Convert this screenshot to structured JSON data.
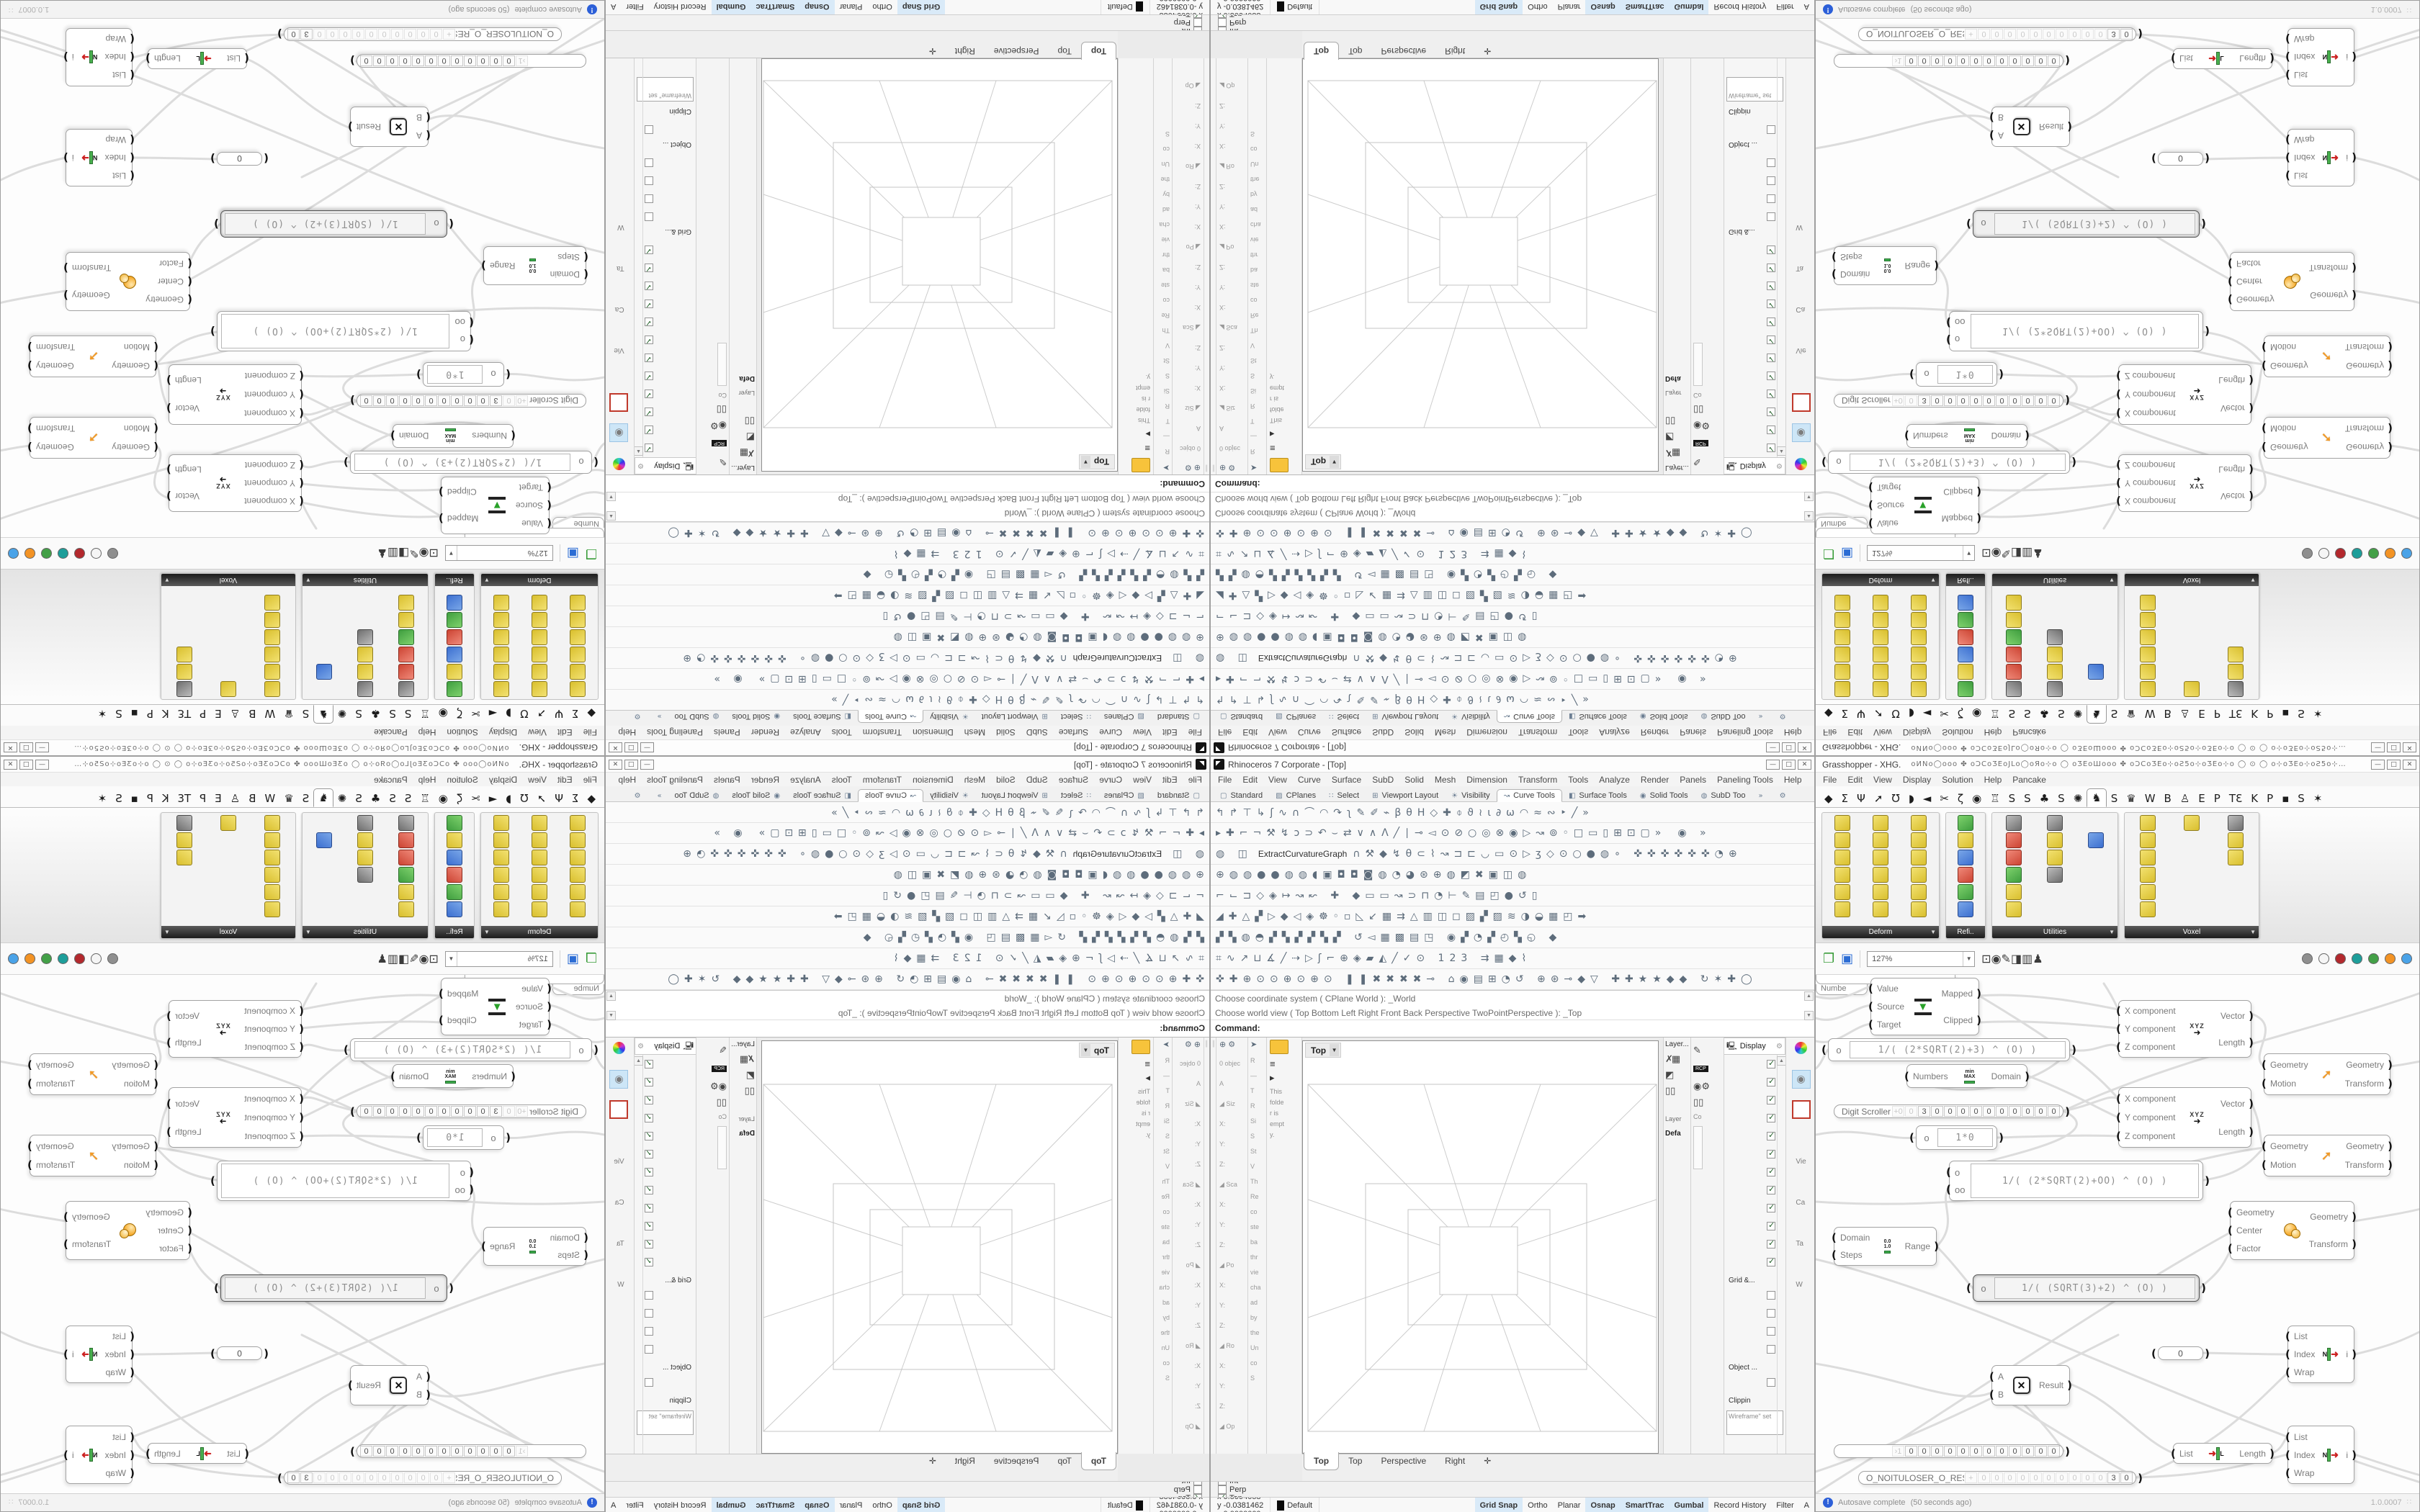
{
  "rhino": {
    "title": "Rhinoceros 7 Corporate - [Top]",
    "window_buttons": [
      "—",
      "□",
      "✕"
    ],
    "menu": [
      "File",
      "Edit",
      "View",
      "Curve",
      "Surface",
      "SubD",
      "Solid",
      "Mesh",
      "Dimension",
      "Transform",
      "Tools",
      "Analyze",
      "Render",
      "Panels",
      "Paneling Tools",
      "Help"
    ],
    "toolbar_tabs": [
      {
        "icon": "▢",
        "label": "Standard"
      },
      {
        "icon": "▨",
        "label": "CPlanes"
      },
      {
        "icon": "∷",
        "label": "Select"
      },
      {
        "icon": "⊞",
        "label": "Viewport Layout"
      },
      {
        "icon": "☀",
        "label": "Visibility"
      },
      {
        "icon": "↝",
        "label": "Curve Tools",
        "active": true
      },
      {
        "icon": "◧",
        "label": "Surface Tools"
      },
      {
        "icon": "◉",
        "label": "Solid Tools"
      },
      {
        "icon": "◍",
        "label": "SubD Too"
      },
      {
        "icon": "»",
        "label": ""
      },
      {
        "icon": "⚙",
        "label": ""
      }
    ],
    "toolbar_rows": [
      {
        "a": "↰↱⊤↳ʃ∿∩⌒◠↷ʅ✎✐⌁βθΗ◇✚⌽ϑ≀ι∂ω◠≈∾‣╱»",
        "label": "",
        "b": ""
      },
      {
        "a": "▸✚⌐¬⚒↯ɔ⊃↶⌣⇄∨∧Λ╱∣⊸◅⊙⊘○◎⊗◉▷↝⊚◦□▭▯⊞⊡▢»",
        "label": "",
        "b": "◉ »"
      },
      {
        "a": "◍ ◫",
        "label": "ExtractCurvatureGraph",
        "b": "∩⚒◆↯θ⊂⌇↝⊐⊏◡▭⊙▷ʒ◇⊙○●◍∘ ✜✜✜✜✜✜◔⊕"
      },
      {
        "a": "⊕◍◍●●◍◍◖▣◘◘◙◍◔◕⊛⊕◍◩✖▣◫◍",
        "label": "",
        "b": ""
      },
      {
        "a": "⌐⌙⊐◇◈↦↝↜ ✚ ◆▭▭↝⊃⊓◔⊢✎▤◰●↺▯",
        "label": "",
        "b": ""
      },
      {
        "a": "◢✚△▞▷◆◁◈☸◦▫◺↙▦⇉△▥◫◻▨▞▨≋◑◒▦◰➡",
        "label": "",
        "b": ""
      },
      {
        "a": "▞▚◍◓▞▚▞▞▚▞ ↺◅▦▩▤◳ ◉▞◔▞◴▚◵ ◆",
        "label": "",
        "b": ""
      },
      {
        "a": "⌗∿↗⊔∡╱⇢▷ʃ⌐⊕◈▰◭╱✓⊙ 123 ⇉▦◆⌇",
        "label": "",
        "b": ""
      },
      {
        "a": "✜✚⊕⊙⊙⊕⊙⊕⊙ ❚❚✖✖✖✖⊸ ⌂◉▤⊞◔↺ ⊕⊛⊸◆▽ ✚✚★★◆◆ ↻✶✚◯",
        "label": "",
        "b": ""
      }
    ],
    "command": {
      "history": [
        "Choose coordinate system ( CPlane  World ): _World",
        "Choose world view ( Top  Bottom  Left  Right  Front  Back  Perspective  TwoPointPerspective ): _Top"
      ],
      "prompt": "Command:"
    },
    "left_panel_a": [
      "0 objec",
      "A",
      "◢ Siz",
      "X:",
      "Y:",
      "Z:",
      "◢ Sca",
      "X:",
      "Y:",
      "Z:",
      "◢ Po",
      "X:",
      "Y:",
      "Z:",
      "◢ Ro",
      "X:",
      "Y:",
      "Z:",
      "◢ Op"
    ],
    "left_panel_b": [
      "R",
      "—",
      "T",
      "R",
      "Si",
      "S",
      "St",
      "V",
      "Th",
      "Re",
      "co",
      "ste",
      "ba",
      "thr",
      "vie",
      "cha",
      "ad",
      "by",
      "the",
      "Un",
      "co",
      "S"
    ],
    "left_panel_c": [
      "This",
      "folde",
      "r is",
      "empt",
      "y."
    ],
    "viewport": {
      "label": "Top",
      "tabs": [
        {
          "label": "Top",
          "active": true
        },
        {
          "label": "Top"
        },
        {
          "label": "Perspective"
        },
        {
          "label": "Right"
        },
        {
          "label": "✛"
        }
      ]
    },
    "layer_panel": {
      "header": "Layer...",
      "list_label": "Layer",
      "item": "Defa"
    },
    "mid_strip": {
      "badge": "RCP",
      "label": "Co"
    },
    "display_panel": {
      "title": "Display",
      "checks": [
        {
          "on": true
        },
        {
          "on": true
        },
        {
          "on": true
        },
        {
          "on": true
        },
        {
          "on": true
        },
        {
          "on": true
        },
        {
          "on": true
        },
        {
          "on": true
        },
        {
          "on": true
        },
        {
          "on": true
        },
        {
          "on": true
        },
        {
          "on": true
        }
      ],
      "grid_label": "Grid &...",
      "grid_checks": [
        {
          "on": false
        },
        {
          "on": false
        },
        {
          "on": false
        },
        {
          "on": false
        }
      ],
      "object_label": "Object ...",
      "object_checks": [
        {
          "on": false
        }
      ],
      "clip_label": "Clippin",
      "setting": "Wireframe\" set"
    },
    "right_strip": [
      "Vie",
      "Ca",
      "Ta",
      "W"
    ],
    "osnap": [
      {
        "label": "End",
        "on": true
      },
      {
        "label": "Near",
        "on": true
      },
      {
        "label": "Point",
        "on": true
      },
      {
        "label": "Mid",
        "on": true
      },
      {
        "label": "Cen",
        "on": true
      },
      {
        "label": "Int",
        "on": true
      },
      {
        "label": "Perp",
        "on": false
      },
      {
        "label": "Tan",
        "on": true
      },
      {
        "label": "Quad",
        "on": true
      },
      {
        "label": "Knot",
        "on": true
      },
      {
        "label": "Vertex",
        "on": true
      },
      {
        "label": "Project",
        "on": false
      },
      {
        "label": "Disable",
        "on": false
      }
    ],
    "status": {
      "segments": [
        "CPlane",
        "x 0.5094058",
        "y -0.0381462",
        "z 0.0000000",
        "Millimeters"
      ],
      "default_label": "Default",
      "toggles": [
        {
          "label": "Grid Snap",
          "on": true
        },
        {
          "label": "Ortho"
        },
        {
          "label": "Planar"
        },
        {
          "label": "Osnap",
          "on": true
        },
        {
          "label": "SmartTrac",
          "on": true
        },
        {
          "label": "Gumbal",
          "on": true
        },
        {
          "label": "Record History"
        },
        {
          "label": "Filter"
        },
        {
          "label": "A"
        }
      ]
    }
  },
  "gh": {
    "title": "Grasshopper - XHG.",
    "title_glyphs": "oИNo◯ooo ✤ oƆCoƷEoJLo◯oЯo⊹o  ◯  oƷEoШooo ✤ oƆCoƷEo⊹oƧ5o⊹oƷEo⊹o  ◯ ⊙ ◯  o⊹oƷEo⊹oƧ5o⊹…",
    "window_buttons": [
      "—",
      "□",
      "✕"
    ],
    "menu": [
      "File",
      "Edit",
      "View",
      "Display",
      "Solution",
      "Help",
      "Pancake"
    ],
    "tabs": [
      {
        "g": "◆"
      },
      {
        "g": "Σ"
      },
      {
        "g": "Ψ"
      },
      {
        "g": "➚"
      },
      {
        "g": "Ʊ"
      },
      {
        "g": "◗"
      },
      {
        "g": "◄"
      },
      {
        "g": "✂"
      },
      {
        "g": "ζ"
      },
      {
        "g": "◉"
      },
      {
        "g": "♖"
      },
      {
        "g": "S"
      },
      {
        "g": "S"
      },
      {
        "g": "♣"
      },
      {
        "g": "S"
      },
      {
        "g": "✺"
      },
      {
        "g": "♞",
        "active": true
      },
      {
        "g": "S"
      },
      {
        "g": "♛"
      },
      {
        "g": "W"
      },
      {
        "g": "B"
      },
      {
        "g": "♙"
      },
      {
        "g": "E"
      },
      {
        "g": "P"
      },
      {
        "g": "TƐ"
      },
      {
        "g": "K"
      },
      {
        "g": "P"
      },
      {
        "g": "▪"
      },
      {
        "g": "S"
      },
      {
        "g": "✶"
      }
    ],
    "palettes": [
      {
        "label": "Deform",
        "cells": [
          "y",
          "y",
          "y",
          "y",
          "y",
          "y",
          "y",
          "y",
          "y",
          "y",
          "y",
          "y",
          "y",
          "y",
          "y",
          "y",
          "y",
          "y"
        ]
      },
      {
        "label": "Refi..",
        "cells": [
          "g",
          "y",
          "b",
          "r",
          "g",
          "b"
        ]
      },
      {
        "label": "Utilities",
        "cells": [
          "k",
          "k",
          "w",
          "r",
          "y",
          "b",
          "r",
          "y",
          "w",
          "g",
          "k",
          "w",
          "y",
          "w",
          "w",
          "y",
          "w",
          "w"
        ]
      },
      {
        "label": "Voxel",
        "cells": [
          "y",
          "y",
          "k",
          "y",
          "w",
          "y",
          "y",
          "w",
          "y",
          "y",
          "w",
          "w",
          "y",
          "w",
          "w",
          "y",
          "w",
          "w"
        ]
      }
    ],
    "toolbar": {
      "zoom": "127%",
      "mid": [
        "⊡",
        "◉",
        "✎",
        "◨",
        "▥",
        "♟"
      ],
      "blobs": [
        "#8f8f8f",
        "#f5f5f5",
        "#b3282d",
        "#1d9e9a",
        "#43a047",
        "#f39324",
        "#4aa3e8"
      ]
    },
    "nodes": {
      "remap": {
        "in": [
          "Value",
          "Source",
          "Target"
        ],
        "out": [
          "Mapped",
          "Clipped"
        ]
      },
      "xyz": {
        "in": [
          "X component",
          "Y component",
          "Z component"
        ],
        "out": [
          "Vector",
          "Length"
        ]
      },
      "move": {
        "in": [
          "Geometry",
          "Motion"
        ],
        "out": [
          "Geometry",
          "Transform"
        ]
      },
      "scale": {
        "in": [
          "Geometry",
          "Center",
          "Factor"
        ],
        "out": [
          "Geometry",
          "Transform"
        ]
      },
      "domain": {
        "in": [
          "Numbers"
        ],
        "out": [
          "Domain"
        ]
      },
      "range": {
        "in": [
          "Domain",
          "Steps"
        ],
        "out": [
          "Range"
        ]
      },
      "mult": {
        "in": [
          "A",
          "B"
        ],
        "out": [
          "Result"
        ]
      },
      "listitem": {
        "in": [
          "List",
          "Index",
          "Wrap"
        ],
        "out": [
          "i"
        ]
      },
      "listlen": {
        "in": [
          "List"
        ],
        "out": [
          "Length"
        ]
      },
      "exprA": {
        "var": "o",
        "expr": "1/( (2*SQRT(2)+3) ^ (O) )"
      },
      "exprB": {
        "vars": [
          "o",
          "oo"
        ],
        "expr": "1/( (2*SQRT(2)+OO) ^ (O) )"
      },
      "exprC": {
        "var": "o",
        "expr": "1/( (SQRT(3)+2) ^ (O) )"
      },
      "exprSmall": {
        "var": "o",
        "expr": "1*0"
      },
      "zero": "0",
      "partial": "Numbe",
      "scroller1": {
        "label": "Digit Scroller",
        "cells": [
          {
            "t": "+0",
            "dim": true
          },
          {
            "t": "0",
            "dim": true
          },
          {
            "t": "3"
          },
          {
            "t": "0"
          },
          {
            "t": "0"
          },
          {
            "t": "0"
          },
          {
            "t": "0"
          },
          {
            "t": "0"
          },
          {
            "t": "0"
          },
          {
            "t": "0"
          },
          {
            "t": "0"
          },
          {
            "t": "0"
          },
          {
            "t": "0"
          }
        ]
      },
      "scroller2": {
        "cells": [
          {
            "t": "›1",
            "dim": true
          },
          {
            "t": "0"
          },
          {
            "t": "0"
          },
          {
            "t": "0"
          },
          {
            "t": "0"
          },
          {
            "t": "0"
          },
          {
            "t": "0"
          },
          {
            "t": "0"
          },
          {
            "t": "0"
          },
          {
            "t": "0"
          },
          {
            "t": "0"
          },
          {
            "t": "0"
          },
          {
            "t": "0"
          }
        ]
      },
      "bigslider": {
        "label": "O_NOITULOSER_O_RESOLUTION_O",
        "cells": [
          {
            "t": "+",
            "dim": true
          },
          {
            "t": "0",
            "dim": true
          },
          {
            "t": "0",
            "dim": true
          },
          {
            "t": "0",
            "dim": true
          },
          {
            "t": "0",
            "dim": true
          },
          {
            "t": "0",
            "dim": true
          },
          {
            "t": "0",
            "dim": true
          },
          {
            "t": "0",
            "dim": true
          },
          {
            "t": "0",
            "dim": true
          },
          {
            "t": "0",
            "dim": true
          },
          {
            "t": "0",
            "dim": true
          },
          {
            "t": "3"
          },
          {
            "t": "0"
          }
        ]
      }
    },
    "status": {
      "autosave": "Autosave complete",
      "ago": "(50 seconds ago)",
      "version": "1.0.0007"
    }
  },
  "colors": {
    "status_active_bg": "#d9eaf8",
    "gh_component_yellow": "#e9d44a",
    "wire": "#dcdcdc",
    "selected_chip_blue": "#cde6f7"
  }
}
